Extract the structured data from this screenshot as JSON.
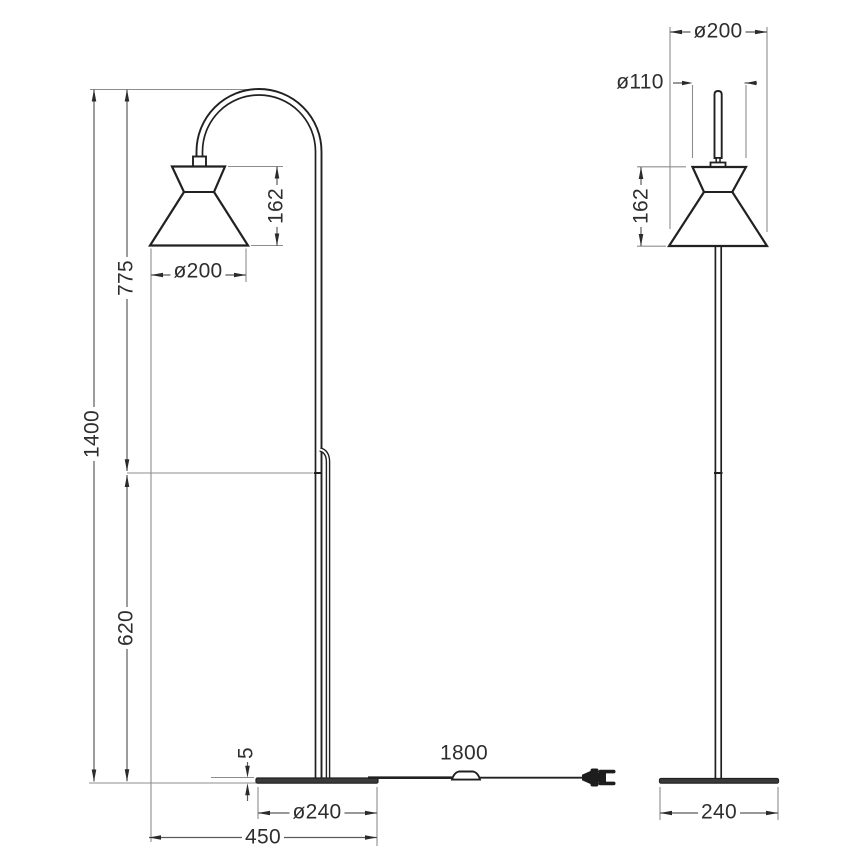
{
  "drawing": {
    "subject": "floor lamp technical dimension drawing, two orthographic views"
  },
  "dimensions": {
    "left": {
      "overall_height": "1400",
      "upper_section_height": "775",
      "lower_section_height": "620",
      "shade_height": "162",
      "shade_diameter": "ø200",
      "base_thickness": "5",
      "cable_length": "1800",
      "base_diameter": "ø240",
      "overall_depth": "450"
    },
    "right": {
      "shade_diameter": "ø200",
      "shade_top_diameter": "ø110",
      "shade_height": "162",
      "base_width": "240"
    }
  },
  "colors": {
    "object_line": "#212121",
    "dimension_line": "#5b5b5b",
    "extension_line": "#8d8d8d",
    "arrow": "#2b2b2b",
    "text": "#2e2e2e",
    "background": "#ffffff"
  }
}
